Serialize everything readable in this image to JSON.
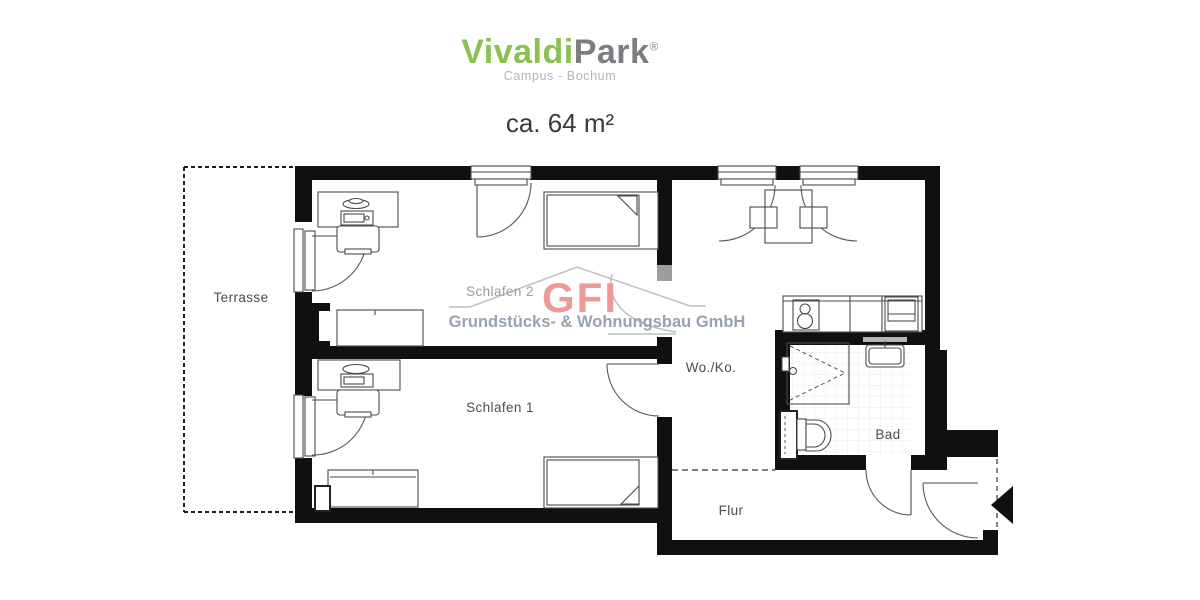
{
  "header": {
    "brand_green": "Vivaldi",
    "brand_gray": "Park",
    "registered": "®",
    "subtitle": "Campus - Bochum",
    "area": "ca. 64 m²"
  },
  "watermark": {
    "logo": "GFI",
    "company": "Grundstücks- & Wohnungsbau GmbH",
    "logo_color": "#ec8f8c",
    "company_color": "#8e98a8"
  },
  "floor_plan": {
    "rooms": {
      "terrace": "Terrasse",
      "bedroom2": "Schlafen 2",
      "bedroom1": "Schlafen 1",
      "living_kitchen": "Wo./Ko.",
      "bath": "Bad",
      "hall": "Flur"
    },
    "colors": {
      "wall": "#101010",
      "brand_green": "#8cc152",
      "brand_gray": "#7b7d80",
      "label_gray": "#4d4d4d"
    }
  }
}
